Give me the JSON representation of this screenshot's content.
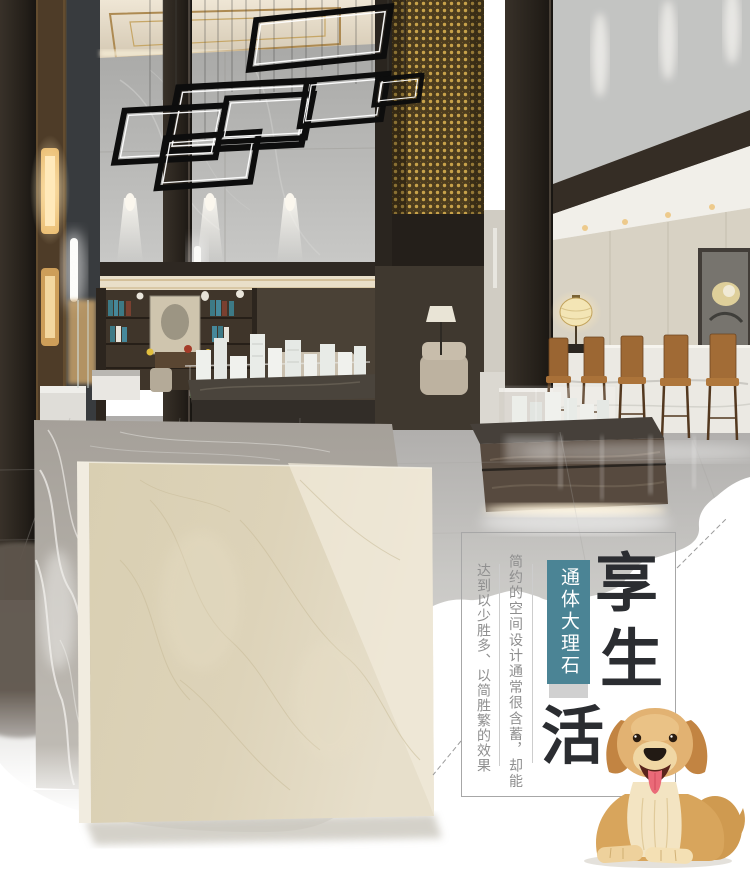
{
  "poster": {
    "slogan": {
      "chars": [
        "享",
        "生",
        "活"
      ],
      "color": "#2b2d31"
    },
    "badge": {
      "label": "通体大理石",
      "bg_color": "#4b8495",
      "base_color": "#d0d0d0"
    },
    "captions": {
      "line_right": "简约的空间设计通常很含蓄，却能",
      "line_left": "达到以少胜多、以简胜繁的效果",
      "color": "#8f8f8f"
    }
  }
}
